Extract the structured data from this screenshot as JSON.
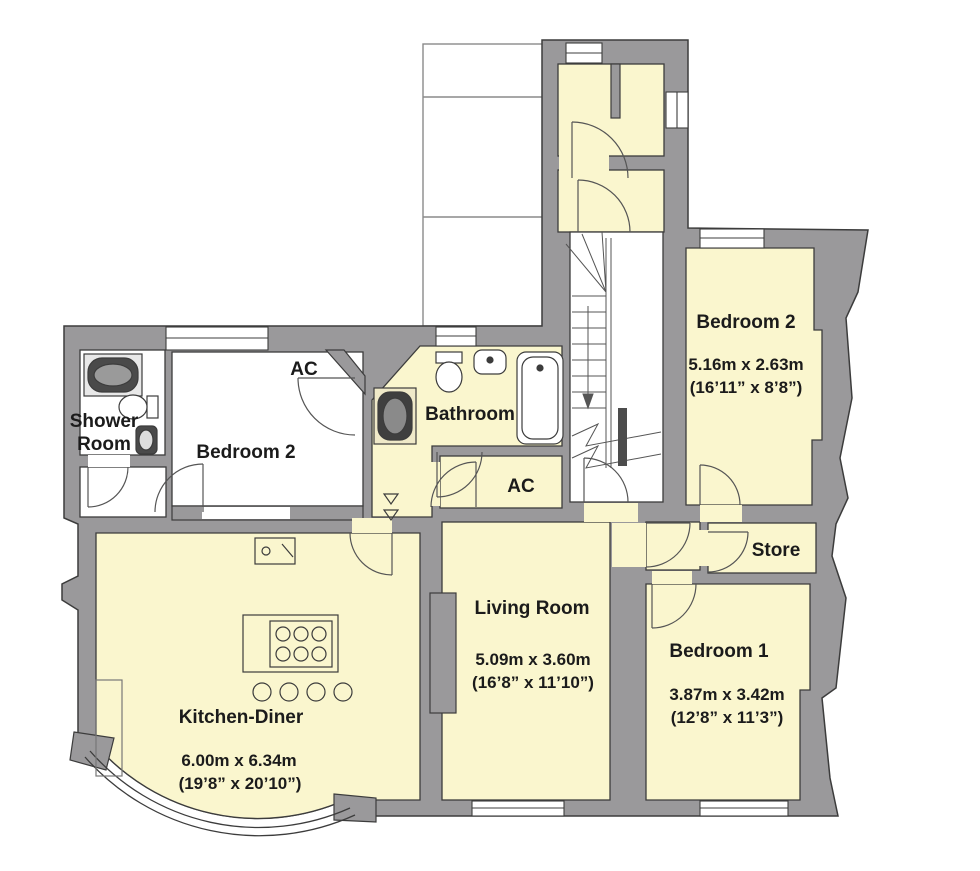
{
  "title": "Floor plan",
  "palette": {
    "wall_gray": "#9A999B",
    "room_yellow": "#FAF6CE",
    "room_white": "#FFFFFF",
    "outline": "#3C3C3C",
    "text": "#1B1B1B"
  },
  "rooms": {
    "shower_room": {
      "name_line1": "Shower",
      "name_line2": "Room"
    },
    "bedroom2_left": {
      "name": "Bedroom 2"
    },
    "ac_closet_left": {
      "name": "AC"
    },
    "bathroom": {
      "name": "Bathroom"
    },
    "ac_closet_inner": {
      "name": "AC"
    },
    "bedroom2_right": {
      "name": "Bedroom 2",
      "size_metric": "5.16m x 2.63m",
      "size_imperial": "(16’11” x 8’8”)"
    },
    "store": {
      "name": "Store"
    },
    "living_room": {
      "name": "Living Room",
      "size_metric": "5.09m x 3.60m",
      "size_imperial": "(16’8” x 11’10”)"
    },
    "bedroom1": {
      "name": "Bedroom 1",
      "size_metric": "3.87m x 3.42m",
      "size_imperial": "(12’8” x 11’3”)"
    },
    "kitchen_diner": {
      "name": "Kitchen-Diner",
      "size_metric": "6.00m x 6.34m",
      "size_imperial": "(19’8” x 20’10”)"
    }
  }
}
